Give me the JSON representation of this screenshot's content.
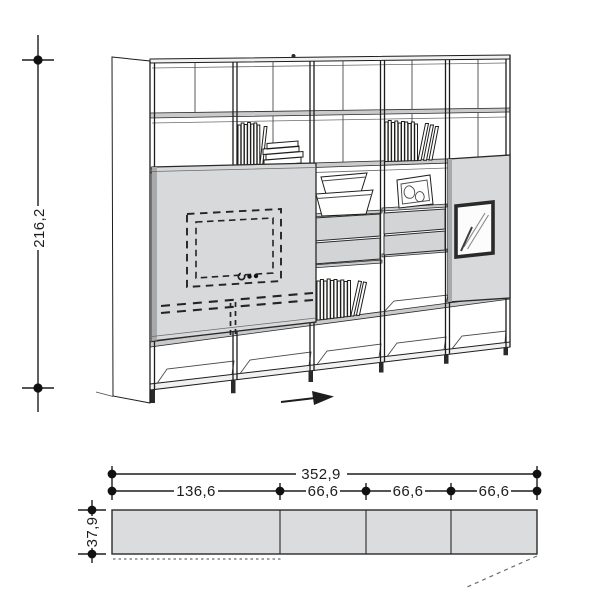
{
  "front_view": {
    "height_label": "216,2"
  },
  "plan_view": {
    "total_width_label": "352,9",
    "segment_labels": [
      "136,6",
      "66,6",
      "66,6",
      "66,6"
    ],
    "depth_label": "37,9"
  },
  "colors": {
    "background": "#ffffff",
    "line": "#1d1d1b",
    "panel_fill": "#d8d9da",
    "panel_edge": "#a7a9ab",
    "shelf_fill": "#c9cacc",
    "drawer_fill": "#d3d4d6",
    "plan_fill": "#dbdcdd",
    "top_band_fill": "#f1f1f1"
  },
  "icons": {
    "slide_direction_arrow": "➔"
  }
}
